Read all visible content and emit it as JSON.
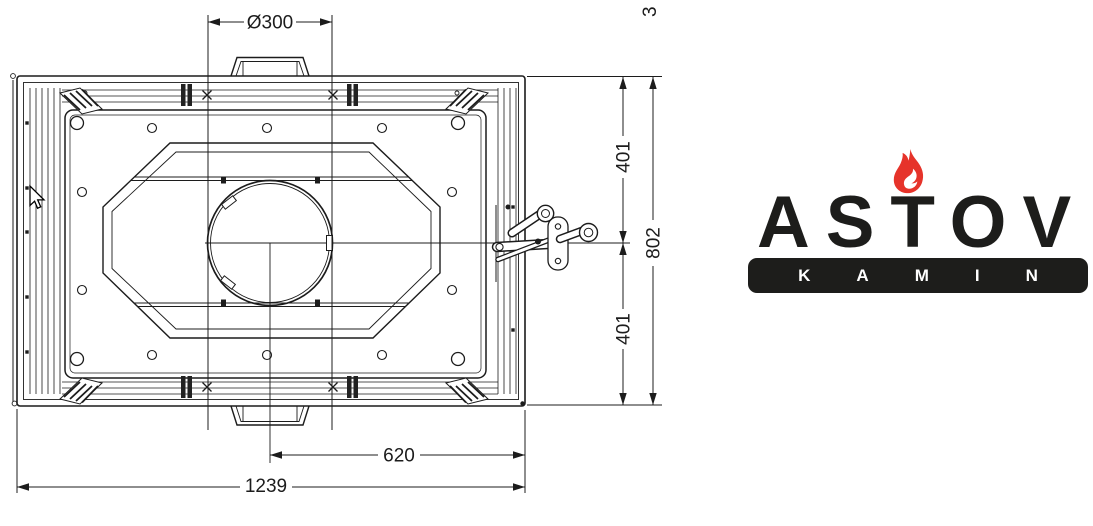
{
  "drawing": {
    "stroke_color": "#1c1c1c",
    "dimensions": {
      "flue_diameter": "Ø300",
      "depth_upper_half": "401",
      "depth_overall": "802",
      "depth_lower_half": "401",
      "width_center_to_right": "620",
      "width_overall": "1239",
      "top_right_clipped": "3"
    }
  },
  "logo": {
    "brand": "ASTOV",
    "subtitle": "KAMIN",
    "colors": {
      "ink": "#1d1d1b",
      "flame": "#e6332a",
      "flame_inner": "#ffffff",
      "bar_text": "#ffffff"
    }
  }
}
